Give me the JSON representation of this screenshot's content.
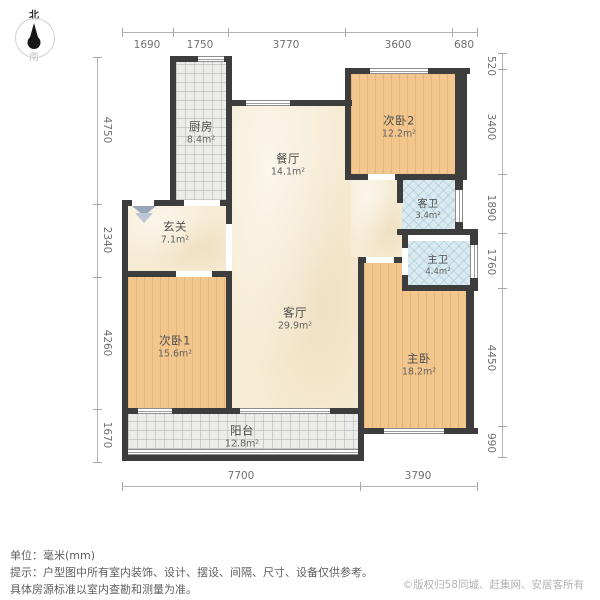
{
  "compass": {
    "north": "北",
    "south": "南"
  },
  "rooms": [
    {
      "id": "kitchen",
      "name": "厨房",
      "area": "8.4m²"
    },
    {
      "id": "dining",
      "name": "餐厅",
      "area": "14.1m²"
    },
    {
      "id": "bedroom2",
      "name": "次卧2",
      "area": "12.2m²"
    },
    {
      "id": "entry",
      "name": "玄关",
      "area": "7.1m²"
    },
    {
      "id": "guest-bath",
      "name": "客卫",
      "area": "3.4m²"
    },
    {
      "id": "master-bath",
      "name": "主卫",
      "area": "4.4m²"
    },
    {
      "id": "bedroom1",
      "name": "次卧1",
      "area": "15.6m²"
    },
    {
      "id": "living",
      "name": "客厅",
      "area": "29.9m²"
    },
    {
      "id": "master-bedroom",
      "name": "主卧",
      "area": "18.2m²"
    },
    {
      "id": "balcony",
      "name": "阳台",
      "area": "12.8m²"
    }
  ],
  "dims": {
    "top": [
      "1690",
      "1750",
      "3770",
      "3600",
      "680"
    ],
    "right": [
      "520",
      "3400",
      "1890",
      "1760",
      "4450",
      "990"
    ],
    "left": [
      "4750",
      "2340",
      "4260",
      "1670"
    ],
    "bottom": [
      "7700",
      "3790"
    ]
  },
  "footer": {
    "unit": "单位：毫米(mm)",
    "tip1": "提示：户型图中所有室内装饰、设计、摆设、间隔、尺寸、设备仅供参考。",
    "tip2": "具体房源标准以室内查勘和测量为准。",
    "copyright": "©版权归58同城、赶集网、安居客所有"
  },
  "colors": {
    "wall": "#3d3d3d",
    "wood_floor": "#f2c68d",
    "marble_floor": "#f6ebd3",
    "tile_gray": "#ececea",
    "tile_blue": "#d9eaf0",
    "dim_line": "#a8a8a8"
  }
}
